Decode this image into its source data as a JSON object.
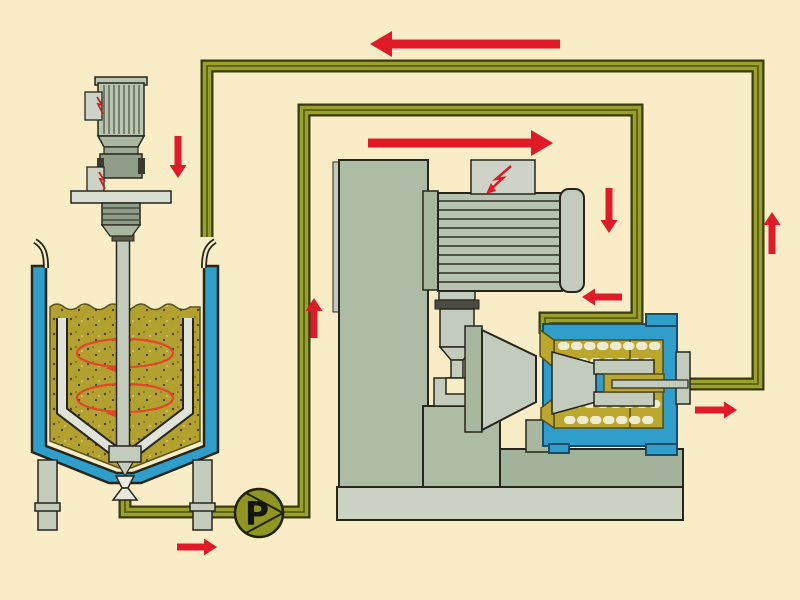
{
  "diagram": {
    "type": "process-flow-diagram",
    "description": "Closed-loop wet milling circuit: jacketed premix tank with agitator, circulation pump and horizontal bead mill",
    "pump": {
      "label": "P"
    },
    "colors": {
      "background": "#f8edc6",
      "pipe_outline": "#383b0d",
      "pipe_fill": "#99a12c",
      "pipe_core": "#5a5e14",
      "arrow_red": "#e11a28",
      "jacket_blue": "#2f9ecb",
      "liquid_olive": "#b2a12e",
      "chamber_olive": "#bba72c",
      "machine_gray": "#aebca6",
      "machine_gray_dark": "#a3b29b",
      "light_gray": "#ccd2c4",
      "steel_light": "#c3cbbd",
      "panel_gray": "#cdd4c7",
      "outline_dark": "#26261a",
      "pump_olive": "#8f961f",
      "ellipse_orange": "#e1472a"
    },
    "arrows": [
      {
        "name": "return-flow-top-arrow",
        "direction": "left",
        "tip_x": 370,
        "tip_y": 44,
        "length": 190,
        "size": "large"
      },
      {
        "name": "feed-flow-to-mill-arrow",
        "direction": "right",
        "tip_x": 553,
        "tip_y": 143,
        "length": 185,
        "size": "large"
      },
      {
        "name": "agitator-feed-down-arrow",
        "direction": "down",
        "tip_x": 178,
        "tip_y": 178,
        "length": 42,
        "size": "small"
      },
      {
        "name": "tank-outlet-arrow",
        "direction": "right",
        "tip_x": 217,
        "tip_y": 547,
        "length": 40,
        "size": "small"
      },
      {
        "name": "riser-up-arrow",
        "direction": "up",
        "tip_x": 314,
        "tip_y": 298,
        "length": 40,
        "size": "small"
      },
      {
        "name": "mill-motor-down-arrow",
        "direction": "down",
        "tip_x": 609,
        "tip_y": 233,
        "length": 45,
        "size": "small"
      },
      {
        "name": "mill-inlet-left-arrow",
        "direction": "left",
        "tip_x": 582,
        "tip_y": 297,
        "length": 40,
        "size": "small"
      },
      {
        "name": "mill-outlet-right-arrow",
        "direction": "right",
        "tip_x": 737,
        "tip_y": 410,
        "length": 42,
        "size": "small"
      },
      {
        "name": "return-riser-up-arrow",
        "direction": "up",
        "tip_x": 772,
        "tip_y": 212,
        "length": 42,
        "size": "small"
      }
    ],
    "components": [
      "agitator-drive-motor",
      "jacketed-premix-tank",
      "agitator-shaft",
      "draft-tube",
      "circulation-ellipses",
      "bottom-outlet-valve",
      "circulation-pump",
      "feed-pipe-loop",
      "return-pipe-loop",
      "mill-stand",
      "mill-drive-motor",
      "bearing-pedestal",
      "bead-mill-grinding-chamber",
      "mill-outlet-flange",
      "machine-base"
    ]
  }
}
